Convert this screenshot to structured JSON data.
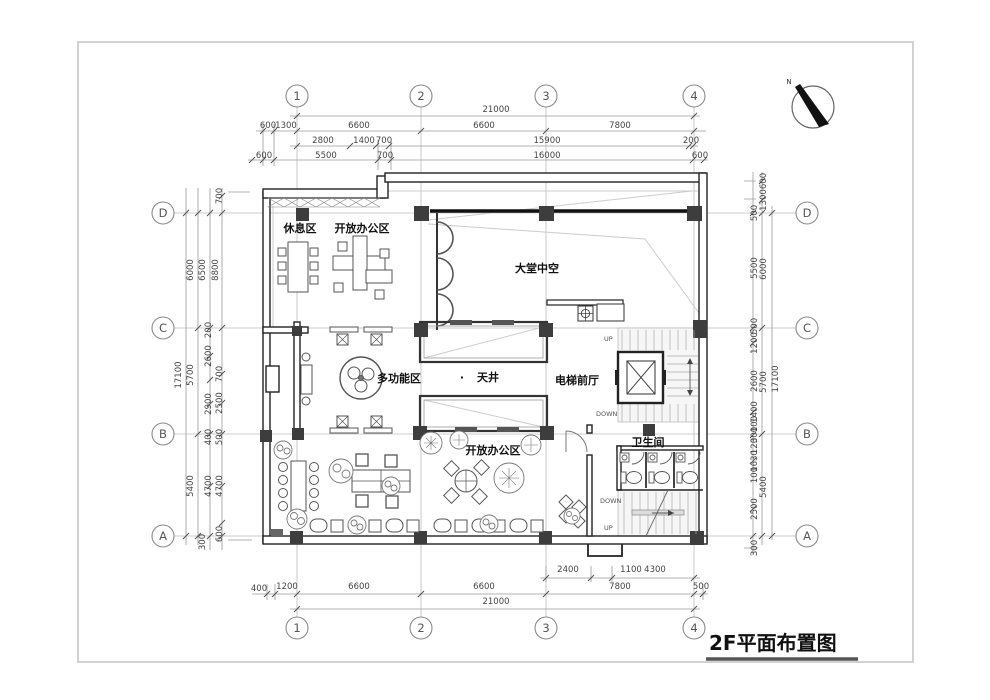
{
  "page": {
    "title": "2F平面布置图"
  },
  "north": {
    "label": "N"
  },
  "grid": {
    "cols": [
      "1",
      "2",
      "3",
      "4"
    ],
    "rows": [
      "D",
      "C",
      "B",
      "A"
    ]
  },
  "rooms": {
    "rest_area": "休息区",
    "open_office_top": "开放办公区",
    "atrium": "大堂中空",
    "multifunction": "多功能区",
    "courtyard_dot": "·",
    "courtyard": "天井",
    "elevator_lobby": "电梯前厅",
    "open_office_bottom": "开放办公区",
    "restroom": "卫生间"
  },
  "stairs": {
    "up_top": "UP",
    "down_top": "DOWN",
    "down_bottom": "DOWN",
    "up_bottom": "UP"
  },
  "dims": {
    "top": [
      "21000",
      "600",
      "1300",
      "6600",
      "6600",
      "7800",
      "2800",
      "1400",
      "700",
      "15900",
      "200",
      "600",
      "5500",
      "700",
      "16000",
      "600"
    ],
    "bottom": [
      "2400",
      "1100",
      "4300",
      "400",
      "1200",
      "6600",
      "6600",
      "7800",
      "500",
      "21000"
    ],
    "left": [
      "700",
      "6000",
      "6500",
      "8800",
      "17100",
      "200",
      "2600",
      "5700",
      "700",
      "2900",
      "2500",
      "400",
      "500",
      "5400",
      "4700",
      "4700",
      "300",
      "600"
    ],
    "right": [
      "600",
      "1300",
      "500",
      "5500",
      "6000",
      "500",
      "1200",
      "2600",
      "5700",
      "17100",
      "1400",
      "100",
      "300",
      "120",
      "1630",
      "100",
      "5400",
      "2500",
      "300"
    ]
  }
}
